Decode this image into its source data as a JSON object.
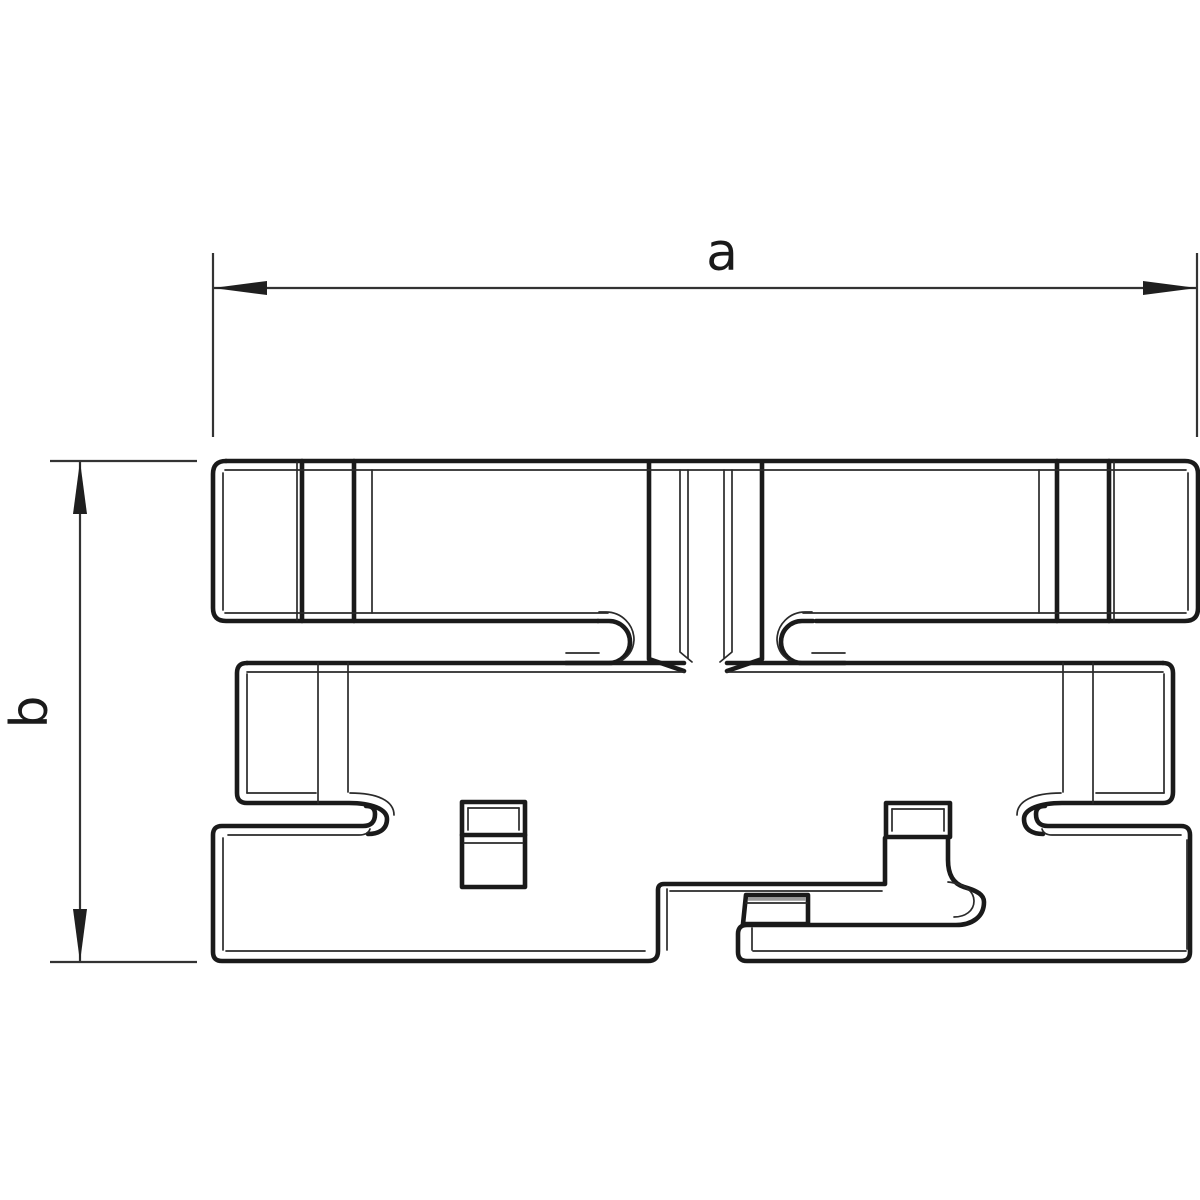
{
  "page": {
    "background": "#ffffff"
  },
  "drawing": {
    "type": "technical-profile-cross-section",
    "line_color": "#1a1a1a",
    "dimension_a": {
      "label": "a",
      "orientation": "horizontal"
    },
    "dimension_b": {
      "label": "b",
      "orientation": "vertical"
    }
  }
}
